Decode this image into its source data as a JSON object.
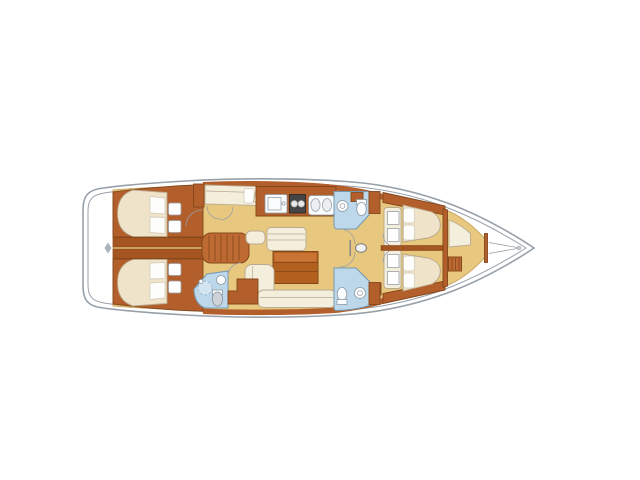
{
  "canvas": {
    "width": 640,
    "height": 480,
    "background": "#ffffff"
  },
  "colors": {
    "hull-gray": "#98a0a8",
    "wood-main": "#b35f2b",
    "wood-dark": "#84471b",
    "wood-band": "#a5551f",
    "steps": "#bd6a33",
    "floor-tan": "#e7c87e",
    "floor-edge": "#c2a058",
    "bed-beige": "#efe3ca",
    "bed-outline": "#b7a68a",
    "pillow": "#fdfdfc",
    "pillow-outline": "#cfc6b5",
    "cream": "#f4eedd",
    "cream-outline": "#b9ab90",
    "head-blue": "#bdd8ea",
    "head-blue-dark": "#7499b3",
    "fixture-blue": "#d3e5f0",
    "fixture-white": "#fafcfd",
    "stove-dark": "#454545",
    "table-brown": "#b2601e",
    "table-light": "#c97434"
  },
  "plan": {
    "type": "sailboat-interior-floor-plan",
    "orientation": "bow-right",
    "double_berths": 4,
    "single_berths": 2,
    "wet_rooms": 3,
    "salon_tables": 1,
    "companionway_steps": 1,
    "mast_posts": 1
  }
}
